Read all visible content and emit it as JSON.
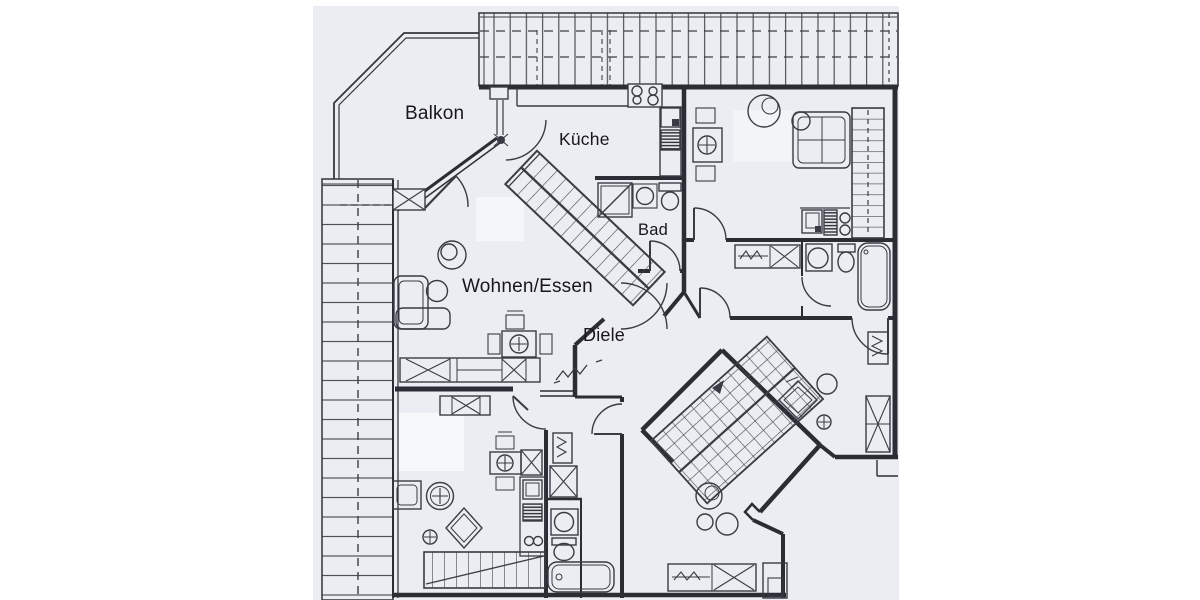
{
  "plan": {
    "rooms": [
      {
        "id": "balkon",
        "label": "Balkon"
      },
      {
        "id": "kueche",
        "label": "Küche"
      },
      {
        "id": "bad",
        "label": "Bad"
      },
      {
        "id": "wohnen_essen",
        "label": "Wohnen/Essen"
      },
      {
        "id": "diele",
        "label": "Diele"
      }
    ],
    "colors": {
      "page": "#ffffff",
      "paper": "#ecedf3",
      "ink": "#2c2d34",
      "text": "#17171a"
    },
    "symbols": [
      "roof-hatching-strip",
      "staircase-straight",
      "staircase-quarter-turn",
      "door-swing",
      "stove-burners",
      "kitchen-sink",
      "dishwasher-hatch",
      "shower",
      "washbasin",
      "toilet",
      "bathtub",
      "wardrobe-crossbox",
      "radiator-zigzag",
      "dining-table-cross",
      "chair",
      "corner-sofa",
      "round-table",
      "plant-circle",
      "armchair",
      "bed"
    ]
  }
}
